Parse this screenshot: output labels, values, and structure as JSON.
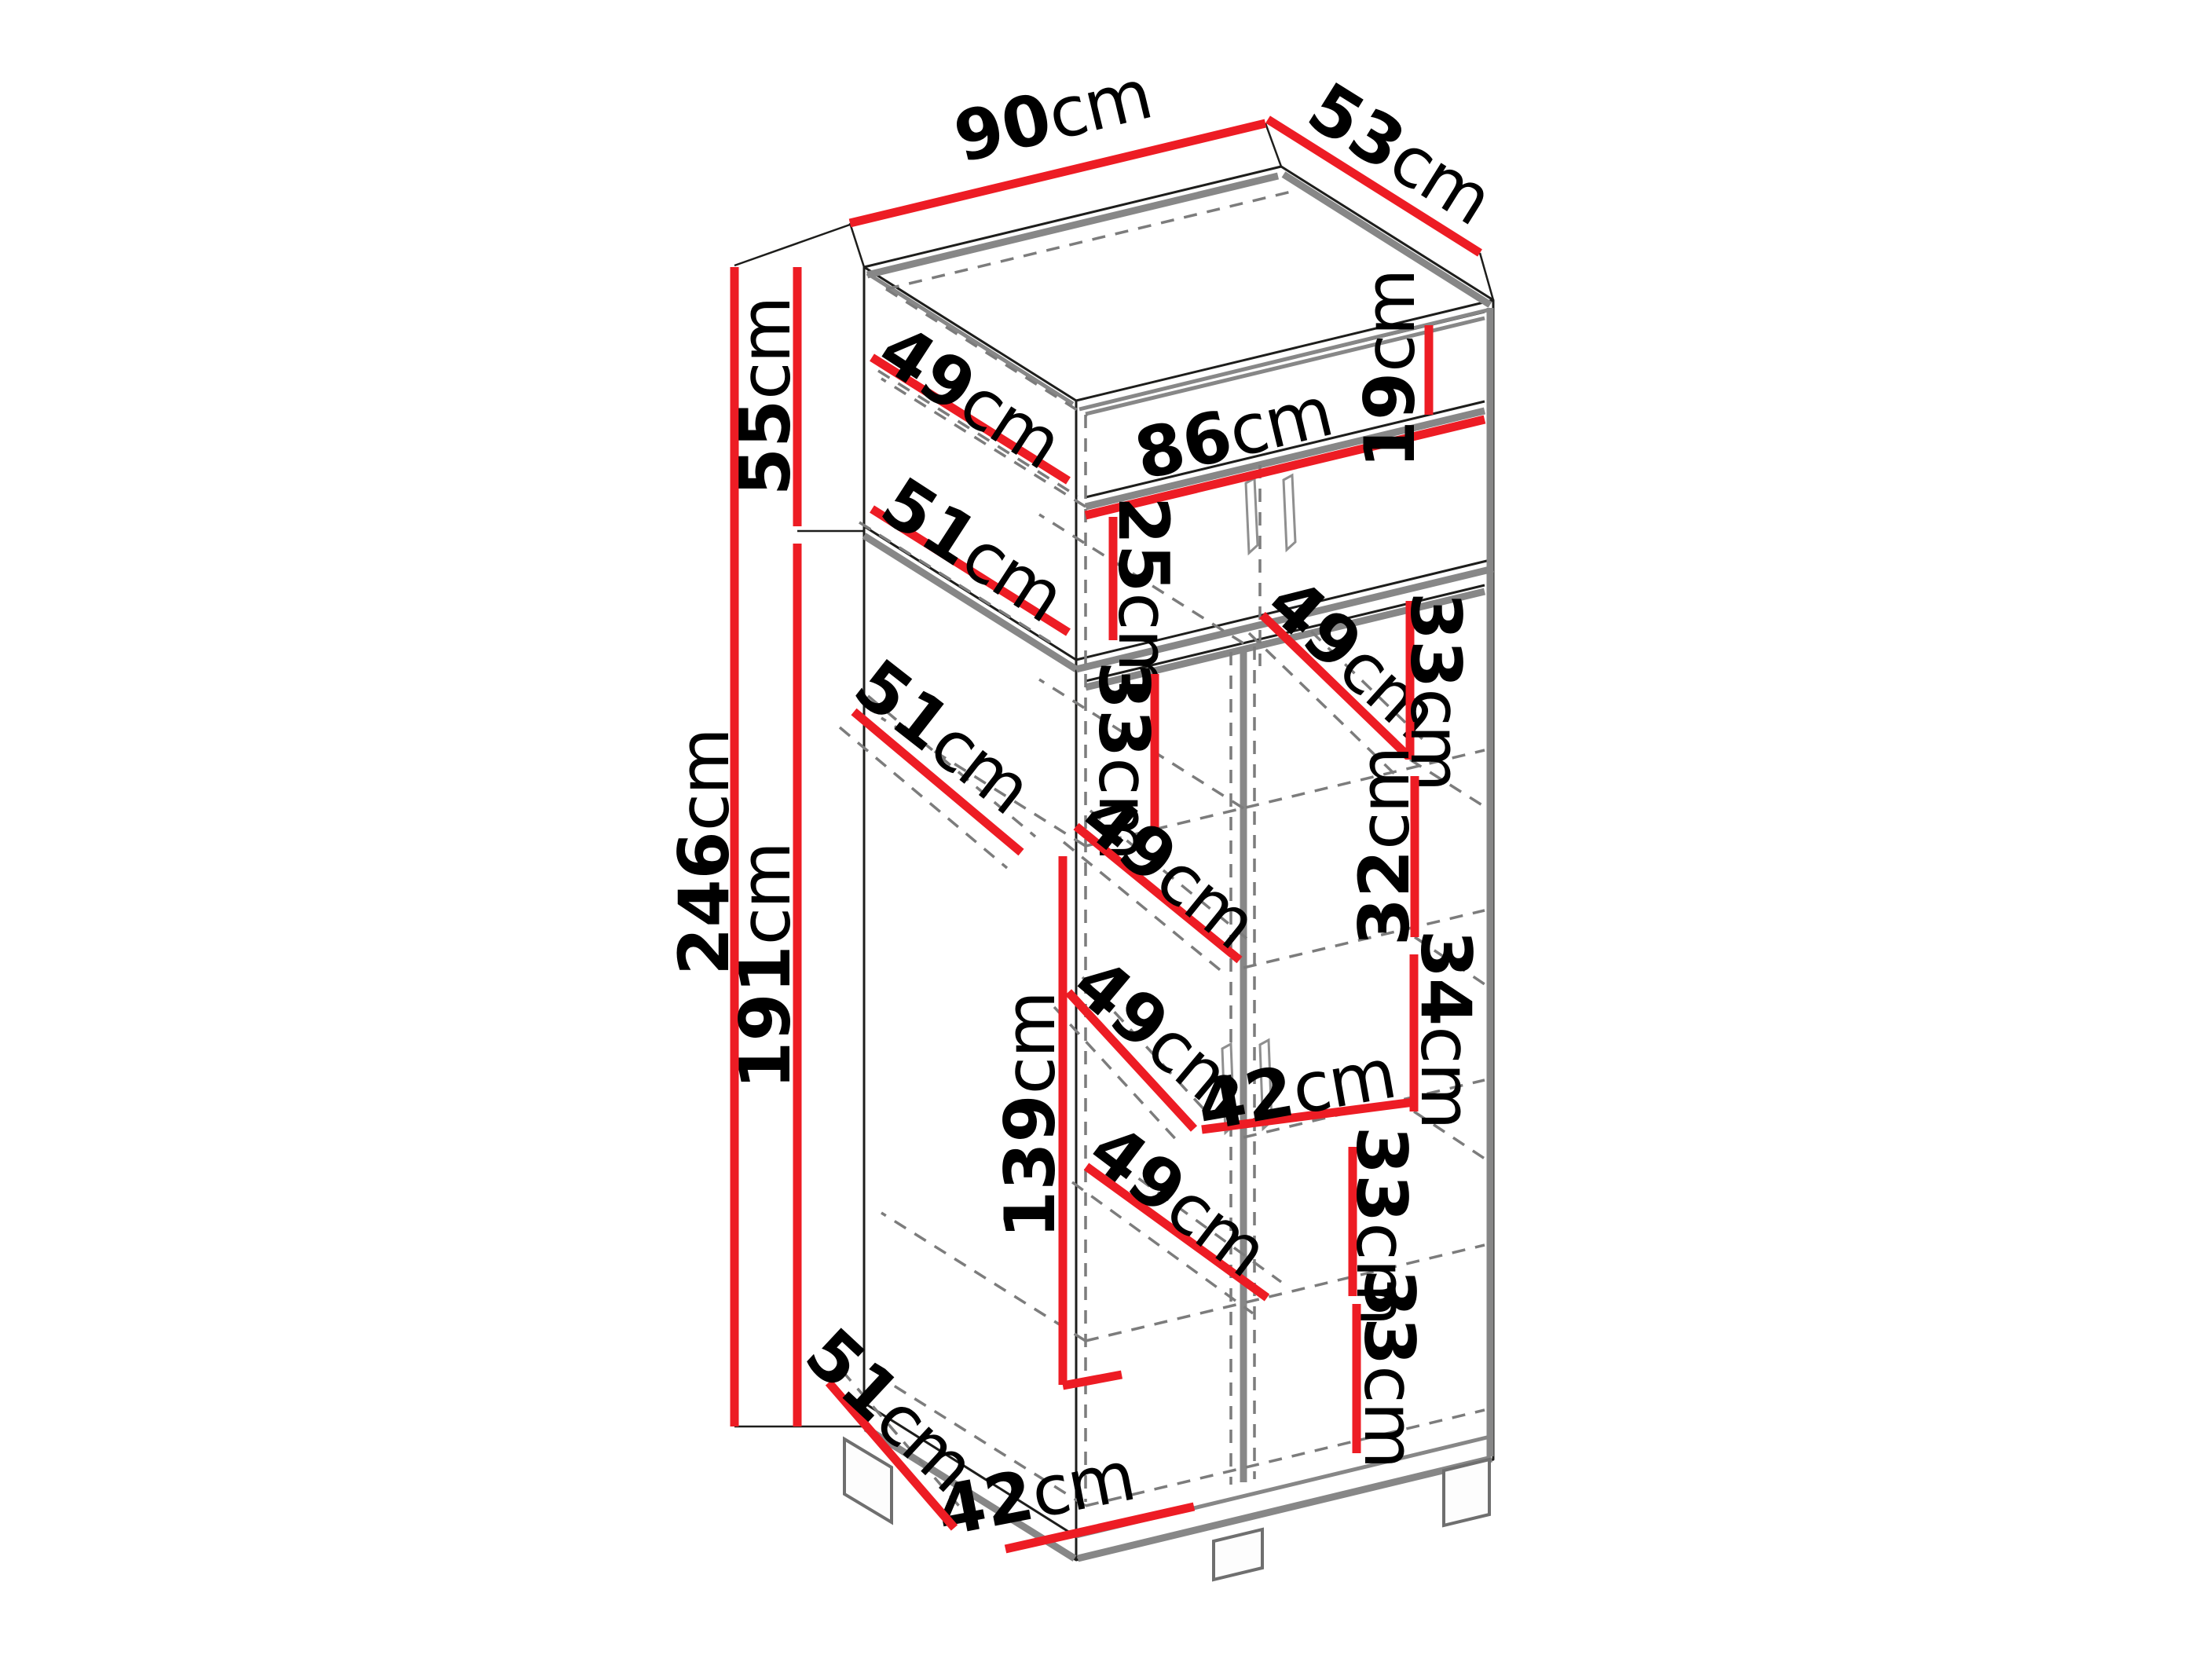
{
  "diagram": {
    "subject": "wardrobe-dimension-technical-drawing",
    "units": "cm",
    "colors": {
      "dimension_line": "#ed1c24",
      "outline": "#1d1d1b",
      "panel_edge": "#878787",
      "hidden_edge": "#7c7c7c",
      "label_text": "#000000",
      "background": "#ffffff"
    },
    "overall": {
      "width": "90cm",
      "depth": "53cm",
      "total_height": "246cm",
      "top_section_height": "55cm",
      "bottom_section_height": "191cm"
    },
    "dims": {
      "d90": {
        "num": "90",
        "unit": "cm"
      },
      "d53": {
        "num": "53",
        "unit": "cm"
      },
      "d55": {
        "num": "55",
        "unit": "cm"
      },
      "d246": {
        "num": "246",
        "unit": "cm"
      },
      "d191": {
        "num": "191",
        "unit": "cm"
      },
      "d49t": {
        "num": "49",
        "unit": "cm"
      },
      "d51t": {
        "num": "51",
        "unit": "cm"
      },
      "d86": {
        "num": "86",
        "unit": "cm"
      },
      "d19": {
        "num": "19",
        "unit": "cm"
      },
      "d25": {
        "num": "25",
        "unit": "cm"
      },
      "d49a": {
        "num": "49",
        "unit": "cm"
      },
      "d33a": {
        "num": "33",
        "unit": "cm"
      },
      "d51m": {
        "num": "51",
        "unit": "cm"
      },
      "d33b": {
        "num": "33",
        "unit": "cm"
      },
      "d49b": {
        "num": "49",
        "unit": "cm"
      },
      "d32": {
        "num": "32",
        "unit": "cm"
      },
      "d49c": {
        "num": "49",
        "unit": "cm"
      },
      "d34": {
        "num": "34",
        "unit": "cm"
      },
      "d42a": {
        "num": "42",
        "unit": "cm"
      },
      "d49d": {
        "num": "49",
        "unit": "cm"
      },
      "d33c": {
        "num": "33",
        "unit": "cm"
      },
      "d139": {
        "num": "139",
        "unit": "cm"
      },
      "d42b": {
        "num": "42",
        "unit": "cm"
      },
      "d33d": {
        "num": "33",
        "unit": "cm"
      },
      "d51b": {
        "num": "51",
        "unit": "cm"
      }
    }
  }
}
